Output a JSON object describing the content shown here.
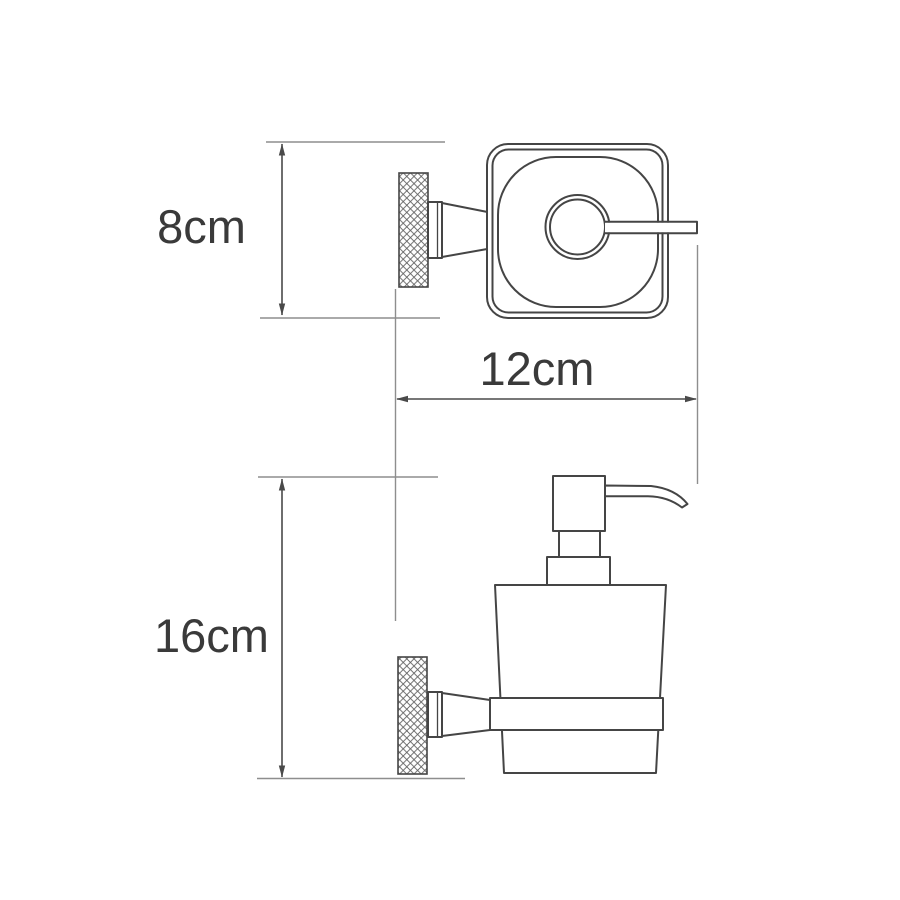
{
  "colors": {
    "background": "#ffffff",
    "object_line": "#454545",
    "extension_line": "#8e8e8e",
    "dimension_line": "#4a4a4a",
    "label_text": "#3a3a3a",
    "knurl_line": "#5f5f5f"
  },
  "dimension_labels": {
    "top_height": "8cm",
    "width": "12cm",
    "side_height": "16cm"
  }
}
